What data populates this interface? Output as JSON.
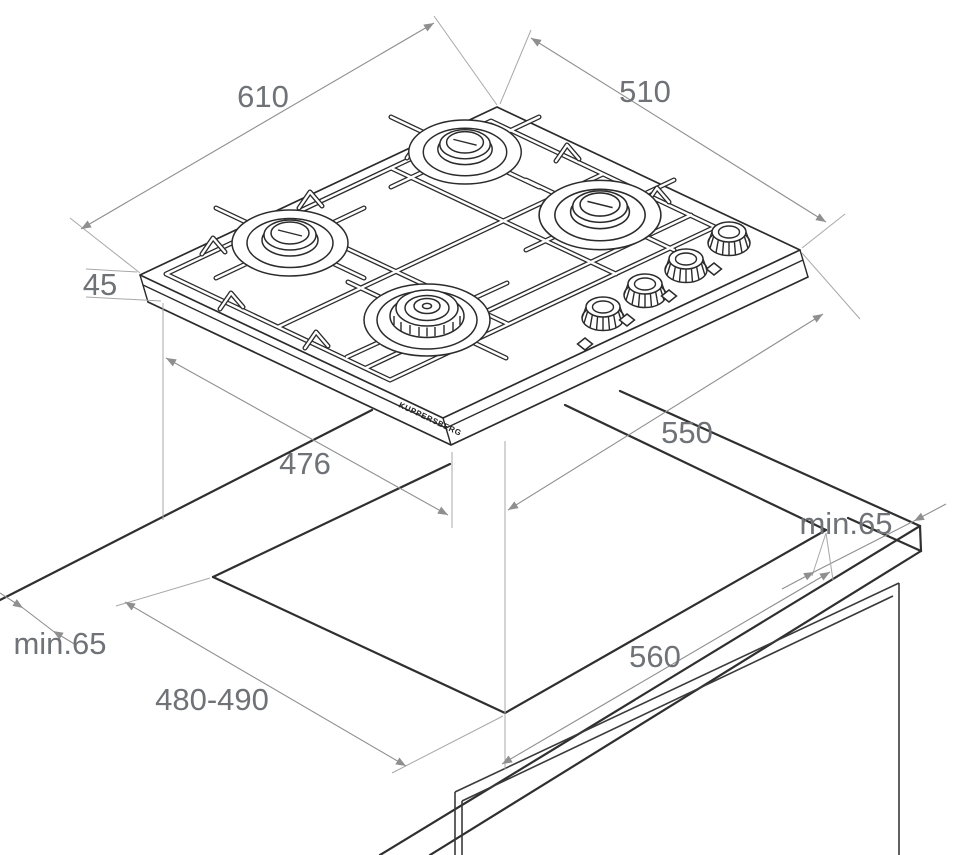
{
  "brand": {
    "label": "KUPPERSBERG"
  },
  "dimensions": {
    "width_top": {
      "label": "610"
    },
    "depth_top": {
      "label": "510"
    },
    "height_side": {
      "label": "45"
    },
    "body_depth": {
      "label": "476"
    },
    "cutout_offset": {
      "label": "550"
    },
    "clearance_right": {
      "label": "min.65"
    },
    "cutout_width": {
      "label": "560"
    },
    "clearance_left": {
      "label": "min.65"
    },
    "cutout_depth": {
      "label": "480-490"
    }
  },
  "colors": {
    "line": "#2b2b2b",
    "dimension": "#8f8f8f",
    "label_text": "#6f7276",
    "background": "#ffffff"
  }
}
